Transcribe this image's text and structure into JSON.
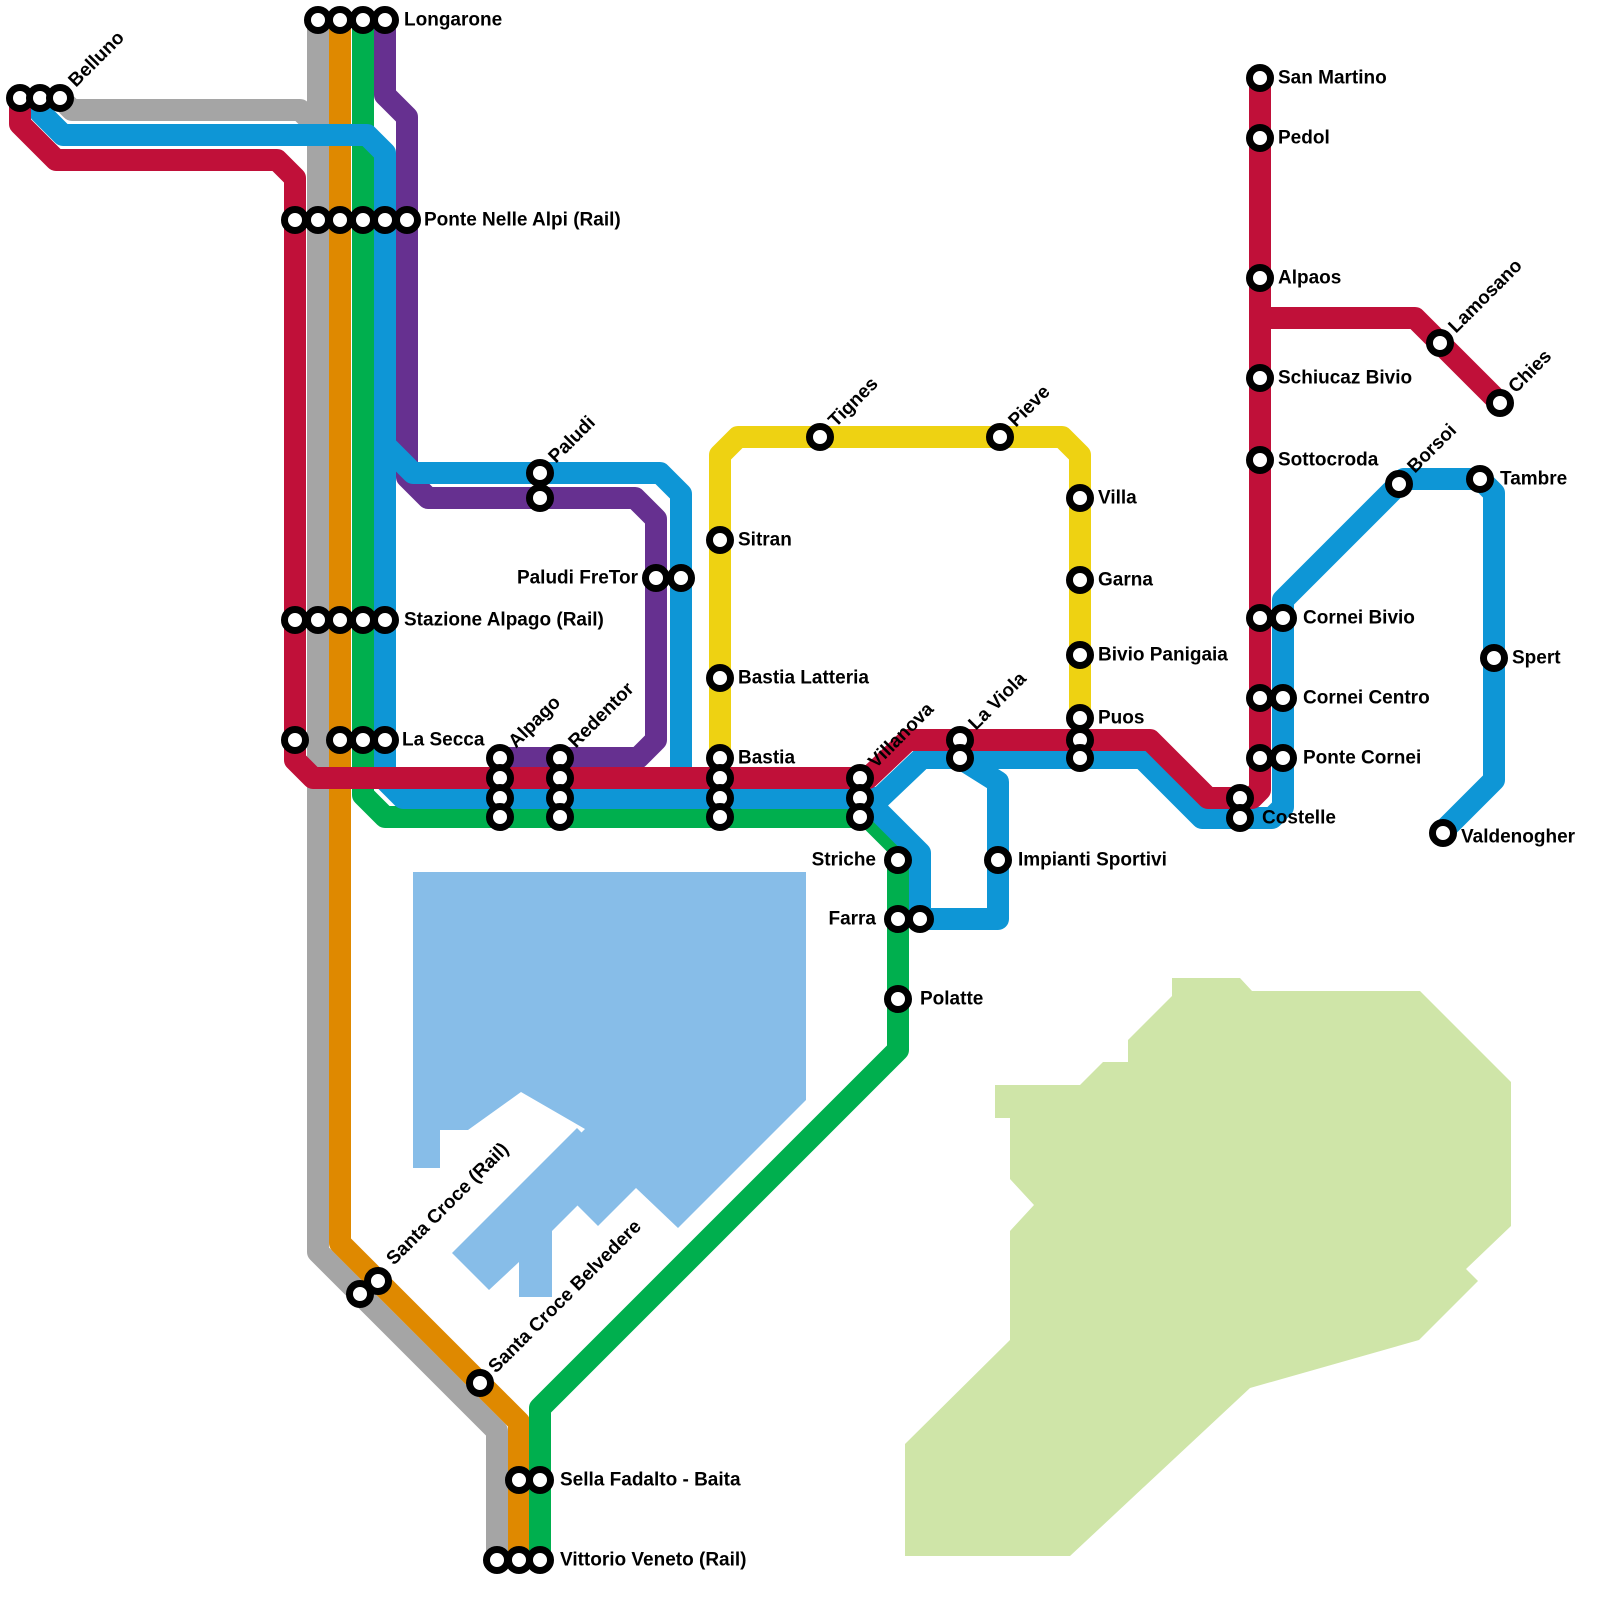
{
  "canvas": {
    "width": 1600,
    "height": 1600,
    "background": "#ffffff"
  },
  "style": {
    "line_width": 22,
    "marker_radius": 10.5,
    "marker_fill": "#ffffff",
    "marker_stroke": "#000000",
    "marker_stroke_width": 7,
    "label_font_size": 19,
    "label_color": "#000000"
  },
  "areas": [
    {
      "id": "lake",
      "fill": "#87bde8",
      "paths": [
        "M 413 872 L 806 872 L 806 1100 L 678 1228 L 636 1188 L 598 1226 L 543 1171 L 585 1129 L 521 1092 L 468 1130 L 440 1130 L 440 1168 L 413 1168 Z",
        "M 452 1253 L 577 1128 L 616 1167 L 552 1231 L 552 1297 L 519 1297 L 519 1262 L 489 1290 Z"
      ]
    },
    {
      "id": "plateau",
      "fill": "#cfe5a8",
      "paths": [
        "M 1172 978 L 1240 978 L 1252 991 L 1420 991 L 1511 1082 L 1511 1226 L 1466 1269 L 1478 1281 L 1419 1340 L 1250 1388 L 1070 1556 L 905 1556 L 905 1444 L 1010 1340 L 1010 1231 L 1034 1205 L 1010 1179 L 1010 1118 L 995 1118 L 995 1085 L 1080 1085 L 1103 1062 L 1128 1062 L 1128 1040 L 1172 996 Z"
      ]
    }
  ],
  "lines": [
    {
      "id": "gray-line",
      "color": "#a5a5a5",
      "paths": [
        "M 318 20 L 318 1252 L 497 1431 L 497 1560",
        "M 60 98 L 72 110 L 300 110 L 318 128"
      ]
    },
    {
      "id": "orange-line",
      "color": "#df8900",
      "paths": [
        "M 340 20 L 340 1243 L 519 1422 L 519 1560"
      ]
    },
    {
      "id": "green-line",
      "color": "#00af4e",
      "paths": [
        "M 363 20 L 363 795 L 385 817 L 868 817 L 898 847 L 898 1050 L 540 1408 L 540 1560"
      ]
    },
    {
      "id": "yellow-line",
      "color": "#eed212",
      "paths": [
        "M 720 758 L 720 455 L 738 437 L 1062 437 L 1080 455 L 1080 718"
      ]
    },
    {
      "id": "purple-line",
      "color": "#663090",
      "paths": [
        "M 385 20 L 385 95 L 407 117 L 407 477 L 428 498 L 635 498 L 656 519 L 656 740 L 638 758 L 500 758"
      ]
    },
    {
      "id": "blue-line",
      "color": "#0e96d6",
      "paths": [
        "M 40 98 L 40 112 L 63 135 L 367 135 L 385 153 L 385 780 L 403 798 L 880 798 L 922 758 L 1142 758 L 1202 818 L 1272 818 L 1283 807 L 1283 600 L 1404 479 L 1480 479 L 1494 493 L 1494 780 L 1443 831",
        "M 385 445 L 413 473 L 660 473 L 681 494 L 681 798",
        "M 867 800 L 920 853 L 920 919 L 998 919 L 998 782 L 963 760"
      ]
    },
    {
      "id": "red-line",
      "color": "#c01039",
      "paths": [
        "M 20 98 L 20 124 L 56 160 L 277 160 L 295 178 L 295 760 L 313 778 L 868 778 L 908 740 L 1150 740 L 1208 798 L 1252 798 L 1260 790 L 1260 78",
        "M 1260 318 L 1415 318 L 1500 403"
      ]
    }
  ],
  "stations": [
    {
      "name": "Longarone",
      "label": {
        "x": 404,
        "y": 20,
        "rotate": 0,
        "anchor": "start"
      },
      "markers": [
        [
          318,
          20
        ],
        [
          340,
          20
        ],
        [
          363,
          20
        ],
        [
          385,
          20
        ]
      ]
    },
    {
      "name": "Belluno",
      "label": {
        "x": 72,
        "y": 84,
        "rotate": -45,
        "anchor": "start"
      },
      "markers": [
        [
          20,
          98
        ],
        [
          40,
          98
        ],
        [
          60,
          98
        ]
      ]
    },
    {
      "name": "Ponte Nelle Alpi (Rail)",
      "label": {
        "x": 424,
        "y": 220,
        "rotate": 0,
        "anchor": "start"
      },
      "markers": [
        [
          295,
          220
        ],
        [
          318,
          220
        ],
        [
          340,
          220
        ],
        [
          363,
          220
        ],
        [
          385,
          220
        ],
        [
          407,
          220
        ]
      ]
    },
    {
      "name": "San Martino",
      "label": {
        "x": 1278,
        "y": 78,
        "rotate": 0,
        "anchor": "start"
      },
      "markers": [
        [
          1260,
          78
        ]
      ]
    },
    {
      "name": "Pedol",
      "label": {
        "x": 1278,
        "y": 138,
        "rotate": 0,
        "anchor": "start"
      },
      "markers": [
        [
          1260,
          138
        ]
      ]
    },
    {
      "name": "Alpaos",
      "label": {
        "x": 1278,
        "y": 278,
        "rotate": 0,
        "anchor": "start"
      },
      "markers": [
        [
          1260,
          278
        ]
      ]
    },
    {
      "name": "Lamosano",
      "label": {
        "x": 1452,
        "y": 330,
        "rotate": -45,
        "anchor": "start"
      },
      "markers": [
        [
          1440,
          343
        ]
      ]
    },
    {
      "name": "Chies",
      "label": {
        "x": 1512,
        "y": 390,
        "rotate": -45,
        "anchor": "start"
      },
      "markers": [
        [
          1500,
          403
        ]
      ]
    },
    {
      "name": "Schiucaz Bivio",
      "label": {
        "x": 1278,
        "y": 378,
        "rotate": 0,
        "anchor": "start"
      },
      "markers": [
        [
          1260,
          378
        ]
      ]
    },
    {
      "name": "Sottocroda",
      "label": {
        "x": 1278,
        "y": 460,
        "rotate": 0,
        "anchor": "start"
      },
      "markers": [
        [
          1260,
          460
        ]
      ]
    },
    {
      "name": "Borsoi",
      "label": {
        "x": 1411,
        "y": 470,
        "rotate": -45,
        "anchor": "start"
      },
      "markers": [
        [
          1399,
          484
        ]
      ]
    },
    {
      "name": "Tambre",
      "label": {
        "x": 1500,
        "y": 479,
        "rotate": 0,
        "anchor": "start"
      },
      "markers": [
        [
          1480,
          479
        ]
      ]
    },
    {
      "name": "Paludi",
      "label": {
        "x": 552,
        "y": 460,
        "rotate": -45,
        "anchor": "start"
      },
      "markers": [
        [
          540,
          473
        ],
        [
          540,
          498
        ]
      ]
    },
    {
      "name": "Tignes",
      "label": {
        "x": 832,
        "y": 424,
        "rotate": -45,
        "anchor": "start"
      },
      "markers": [
        [
          820,
          437
        ]
      ]
    },
    {
      "name": "Pieve",
      "label": {
        "x": 1012,
        "y": 424,
        "rotate": -45,
        "anchor": "start"
      },
      "markers": [
        [
          1000,
          437
        ]
      ]
    },
    {
      "name": "Villa",
      "label": {
        "x": 1098,
        "y": 498,
        "rotate": 0,
        "anchor": "start"
      },
      "markers": [
        [
          1080,
          498
        ]
      ]
    },
    {
      "name": "Sitran",
      "label": {
        "x": 738,
        "y": 540,
        "rotate": 0,
        "anchor": "start"
      },
      "markers": [
        [
          720,
          540
        ]
      ]
    },
    {
      "name": "Paludi FreTor",
      "label": {
        "x": 638,
        "y": 578,
        "rotate": 0,
        "anchor": "end"
      },
      "markers": [
        [
          656,
          578
        ],
        [
          681,
          578
        ]
      ]
    },
    {
      "name": "Garna",
      "label": {
        "x": 1098,
        "y": 580,
        "rotate": 0,
        "anchor": "start"
      },
      "markers": [
        [
          1080,
          580
        ]
      ]
    },
    {
      "name": "Stazione Alpago (Rail)",
      "label": {
        "x": 404,
        "y": 620,
        "rotate": 0,
        "anchor": "start"
      },
      "markers": [
        [
          295,
          620
        ],
        [
          318,
          620
        ],
        [
          340,
          620
        ],
        [
          363,
          620
        ],
        [
          385,
          620
        ]
      ]
    },
    {
      "name": "Cornei Bivio",
      "label": {
        "x": 1303,
        "y": 618,
        "rotate": 0,
        "anchor": "start"
      },
      "markers": [
        [
          1260,
          618
        ],
        [
          1283,
          618
        ]
      ]
    },
    {
      "name": "Spert",
      "label": {
        "x": 1512,
        "y": 658,
        "rotate": 0,
        "anchor": "start"
      },
      "markers": [
        [
          1494,
          658
        ]
      ]
    },
    {
      "name": "Bivio Panigaia",
      "label": {
        "x": 1098,
        "y": 655,
        "rotate": 0,
        "anchor": "start"
      },
      "markers": [
        [
          1080,
          655
        ]
      ]
    },
    {
      "name": "Bastia Latteria",
      "label": {
        "x": 738,
        "y": 678,
        "rotate": 0,
        "anchor": "start"
      },
      "markers": [
        [
          720,
          678
        ]
      ]
    },
    {
      "name": "Cornei Centro",
      "label": {
        "x": 1303,
        "y": 698,
        "rotate": 0,
        "anchor": "start"
      },
      "markers": [
        [
          1260,
          698
        ],
        [
          1283,
          698
        ]
      ]
    },
    {
      "name": "La Secca",
      "label": {
        "x": 402,
        "y": 740,
        "rotate": 0,
        "anchor": "start"
      },
      "markers": [
        [
          295,
          740
        ],
        [
          340,
          740
        ],
        [
          363,
          740
        ],
        [
          385,
          740
        ]
      ]
    },
    {
      "name": "Puos",
      "label": {
        "x": 1098,
        "y": 718,
        "rotate": 0,
        "anchor": "start"
      },
      "markers": [
        [
          1080,
          718
        ],
        [
          1080,
          740
        ],
        [
          1080,
          758
        ]
      ]
    },
    {
      "name": "Alpago",
      "label": {
        "x": 512,
        "y": 745,
        "rotate": -45,
        "anchor": "start"
      },
      "markers": [
        [
          500,
          758
        ],
        [
          500,
          778
        ],
        [
          500,
          798
        ],
        [
          500,
          817
        ]
      ]
    },
    {
      "name": "Redentor",
      "label": {
        "x": 572,
        "y": 745,
        "rotate": -45,
        "anchor": "start"
      },
      "markers": [
        [
          560,
          758
        ],
        [
          560,
          778
        ],
        [
          560,
          798
        ],
        [
          560,
          817
        ]
      ]
    },
    {
      "name": "Bastia",
      "label": {
        "x": 738,
        "y": 758,
        "rotate": 0,
        "anchor": "start"
      },
      "markers": [
        [
          720,
          758
        ],
        [
          720,
          778
        ],
        [
          720,
          798
        ],
        [
          720,
          817
        ]
      ]
    },
    {
      "name": "Villanova",
      "label": {
        "x": 872,
        "y": 765,
        "rotate": -45,
        "anchor": "start"
      },
      "markers": [
        [
          860,
          778
        ],
        [
          860,
          798
        ],
        [
          860,
          817
        ]
      ]
    },
    {
      "name": "La Viola",
      "label": {
        "x": 972,
        "y": 727,
        "rotate": -45,
        "anchor": "start"
      },
      "markers": [
        [
          960,
          740
        ],
        [
          960,
          758
        ]
      ]
    },
    {
      "name": "Ponte Cornei",
      "label": {
        "x": 1303,
        "y": 758,
        "rotate": 0,
        "anchor": "start"
      },
      "markers": [
        [
          1260,
          758
        ],
        [
          1283,
          758
        ]
      ]
    },
    {
      "name": "Costelle",
      "label": {
        "x": 1262,
        "y": 818,
        "rotate": 0,
        "anchor": "start"
      },
      "markers": [
        [
          1240,
          798
        ],
        [
          1240,
          818
        ]
      ]
    },
    {
      "name": "Valdenogher",
      "label": {
        "x": 1461,
        "y": 837,
        "rotate": 0,
        "anchor": "start"
      },
      "markers": [
        [
          1443,
          833
        ]
      ]
    },
    {
      "name": "Striche",
      "label": {
        "x": 876,
        "y": 860,
        "rotate": 0,
        "anchor": "end"
      },
      "markers": [
        [
          898,
          860
        ]
      ]
    },
    {
      "name": "Impianti Sportivi",
      "label": {
        "x": 1018,
        "y": 860,
        "rotate": 0,
        "anchor": "start"
      },
      "markers": [
        [
          998,
          860
        ]
      ]
    },
    {
      "name": "Farra",
      "label": {
        "x": 876,
        "y": 919,
        "rotate": 0,
        "anchor": "end"
      },
      "markers": [
        [
          898,
          919
        ],
        [
          920,
          919
        ]
      ]
    },
    {
      "name": "Polatte",
      "label": {
        "x": 920,
        "y": 999,
        "rotate": 0,
        "anchor": "start"
      },
      "markers": [
        [
          898,
          999
        ]
      ]
    },
    {
      "name": "Santa Croce (Rail)",
      "label": {
        "x": 390,
        "y": 1262,
        "rotate": -45,
        "anchor": "start"
      },
      "markers": [
        [
          378,
          1281
        ],
        [
          360,
          1294
        ]
      ]
    },
    {
      "name": "Santa Croce Belvedere",
      "label": {
        "x": 492,
        "y": 1370,
        "rotate": -45,
        "anchor": "start"
      },
      "markers": [
        [
          480,
          1383
        ]
      ]
    },
    {
      "name": "Sella Fadalto - Baita",
      "label": {
        "x": 560,
        "y": 1480,
        "rotate": 0,
        "anchor": "start"
      },
      "markers": [
        [
          519,
          1480
        ],
        [
          540,
          1480
        ]
      ]
    },
    {
      "name": "Vittorio Veneto (Rail)",
      "label": {
        "x": 560,
        "y": 1560,
        "rotate": 0,
        "anchor": "start"
      },
      "markers": [
        [
          497,
          1560
        ],
        [
          519,
          1560
        ],
        [
          540,
          1560
        ]
      ]
    }
  ]
}
